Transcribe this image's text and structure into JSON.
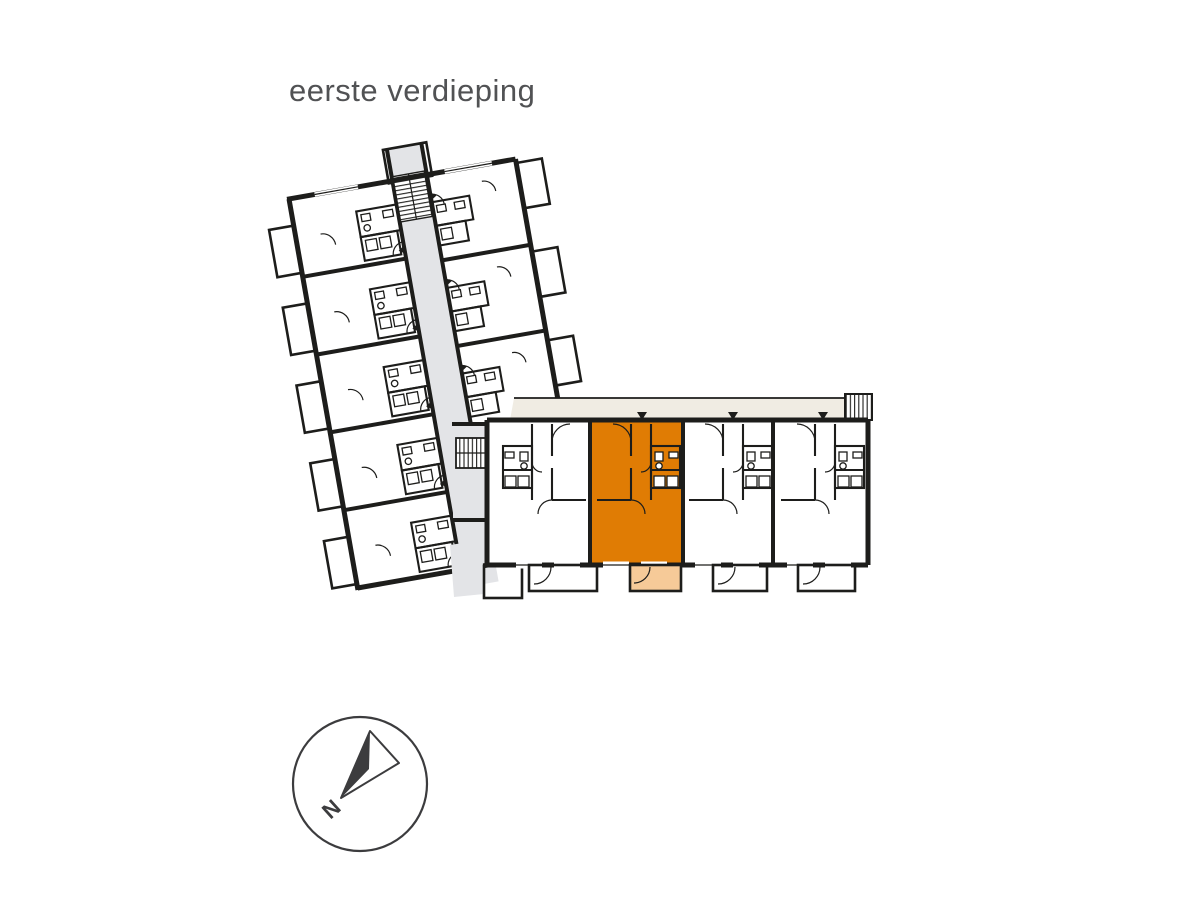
{
  "page": {
    "title": "eerste verdieping"
  },
  "compass": {
    "label": "N"
  },
  "colors": {
    "wall": "#1d1d1b",
    "corridor": "#e3e4e7",
    "gallery": "#f0ece3",
    "highlight_unit": "#e07c04",
    "highlight_balcony": "#f6ca98",
    "title_text": "#515254",
    "compass_stroke": "#3c3c3e"
  },
  "plan": {
    "name": "floor plan - first storey (eerste verdieping)",
    "left_wing": {
      "description": "rotated apartment wing with central corridor",
      "rows_left": 5,
      "rows_right": 3,
      "balconies_left": 5,
      "balconies_right": 3
    },
    "right_wing": {
      "description": "horizontal gallery-access wing",
      "units": 4,
      "balconies": 4
    },
    "highlighted_unit": {
      "label": "selected apartment",
      "wing": "right wing",
      "position": "second unit from left"
    }
  }
}
